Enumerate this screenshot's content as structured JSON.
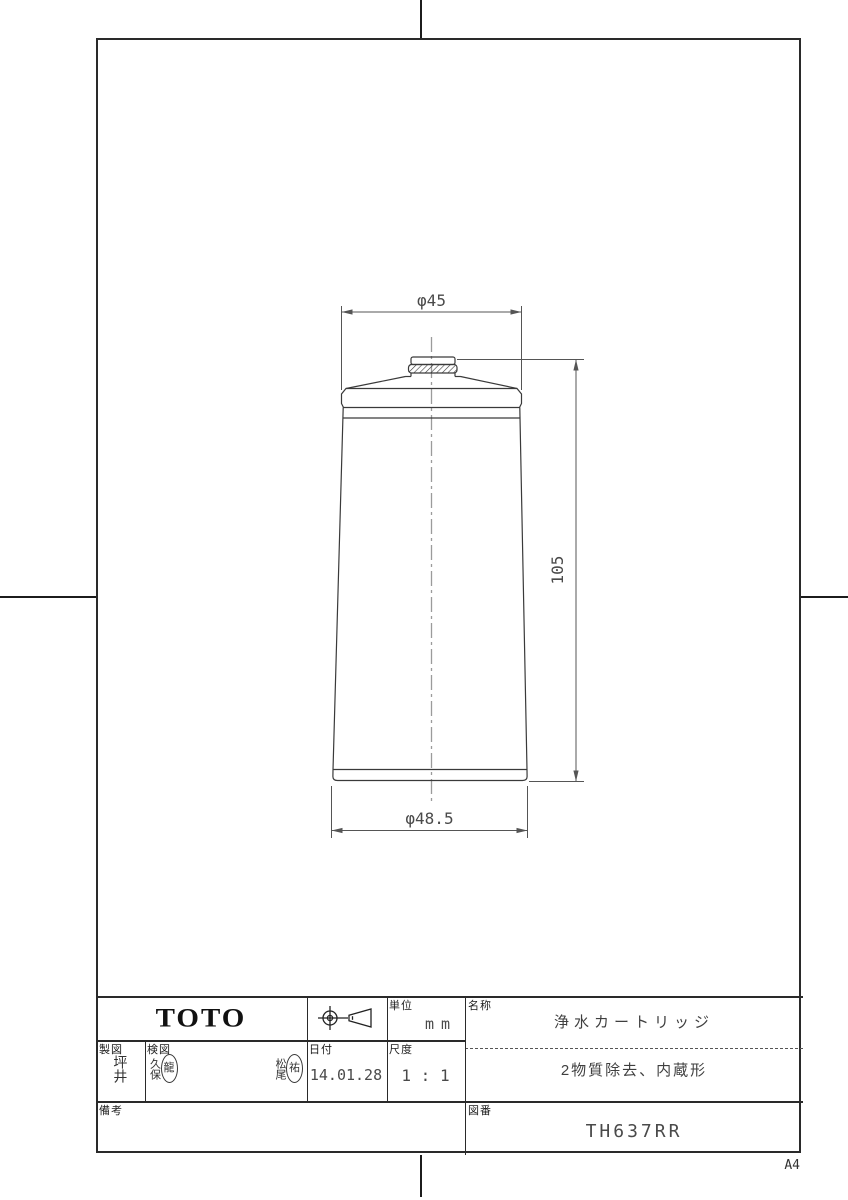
{
  "page": {
    "size_label": "A4"
  },
  "drawing": {
    "dim_top_diameter": "φ45",
    "dim_height": "105",
    "dim_bottom_diameter": "φ48.5"
  },
  "title_block": {
    "logo": "TOTO",
    "unit": {
      "label": "単位",
      "value": "mm"
    },
    "name": {
      "label": "名称",
      "value": "浄水カートリッジ"
    },
    "spec": "2物質除去、内蔵形",
    "drafted": {
      "label": "製図",
      "value": "坪井"
    },
    "checked": {
      "label": "検図",
      "signers": [
        {
          "name": "久保",
          "seal": "龍"
        },
        {
          "name": "松尾",
          "seal": "祐"
        }
      ]
    },
    "date": {
      "label": "日付",
      "value": "14.01.28"
    },
    "scale": {
      "label": "尺度",
      "value": "1 : 1"
    },
    "remarks": {
      "label": "備考",
      "value": ""
    },
    "drawing_number": {
      "label": "図番",
      "value": "TH637RR"
    }
  }
}
